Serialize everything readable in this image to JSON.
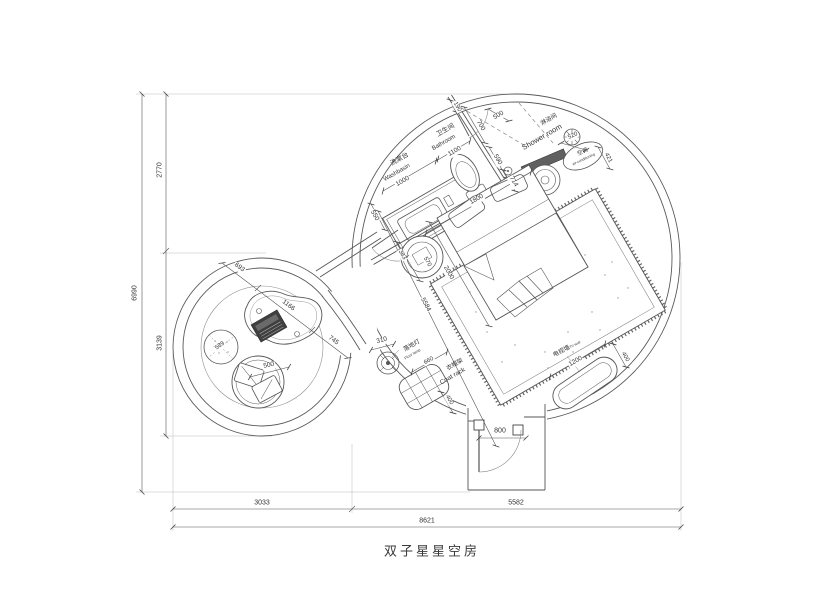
{
  "title": "双子星星空房",
  "labels": {
    "washbasin_cn": "洗漱台",
    "washbasin_en": "Washbasin",
    "bathroom_cn": "卫生间",
    "bathroom_en": "Bathroom",
    "shower_cn": "淋浴间",
    "shower_en": "Shower room",
    "ac_cn": "空调",
    "ac_en": "air-conditioning",
    "floor_lamp_cn": "落地灯",
    "floor_lamp_en": "Floor lamp",
    "coat_rack_cn": "衣帽架",
    "coat_rack_en": "Coat rack",
    "tv_wall_cn": "电视墙",
    "tv_wall_en": "TV wall",
    "tv_cabinet_cn": "电视柜"
  },
  "dims": {
    "overall_width": "8621",
    "width_left": "3033",
    "width_right": "5582",
    "overall_height": "6990",
    "height_top": "2770",
    "height_bottom": "3139",
    "washbasin_len": "1000",
    "basin_depth": "550",
    "bathroom_len": "1100",
    "bath_offset": "190",
    "bath_depth": "700",
    "shower_door": "500",
    "drain": "590",
    "toilet": "714",
    "head_wall": "1800",
    "ac_width": "520",
    "ac_depth": "421",
    "stool_a": "383",
    "stool_b": "570",
    "bed_length": "2000",
    "room_diag": "5584",
    "lamp": "310",
    "rack_length": "660",
    "rack_depth": "400",
    "tv_length": "1200",
    "tv_depth": "400",
    "entry_door": "800",
    "lounge_a": "693",
    "lounge_b": "1166",
    "lounge_c": "745",
    "ottoman": "589",
    "round_chair": "500"
  },
  "colors": {
    "line": "#555555",
    "text": "#333333",
    "dark_fill": "#3f3f3f"
  }
}
